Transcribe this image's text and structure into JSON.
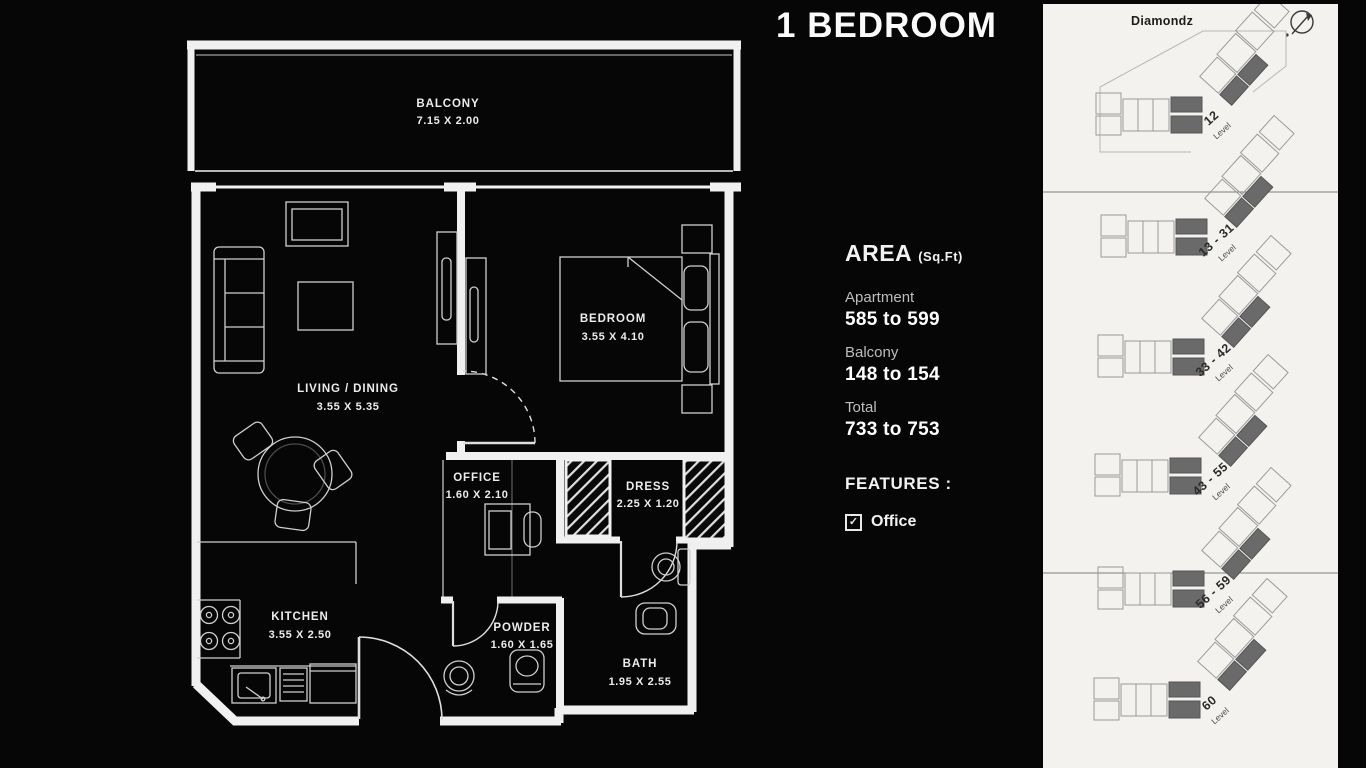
{
  "title": "1 BEDROOM",
  "area": {
    "heading": "AREA",
    "unit": "(Sq.Ft)",
    "rows": [
      {
        "label": "Apartment",
        "value": "585 to 599"
      },
      {
        "label": "Balcony",
        "value": "148 to 154"
      },
      {
        "label": "Total",
        "value": "733 to 753"
      }
    ]
  },
  "features": {
    "heading": "FEATURES :",
    "check_glyph": "✓",
    "items": [
      {
        "label": "Office"
      }
    ]
  },
  "floorplan": {
    "rooms": [
      {
        "name": "BALCONY",
        "dims": "7.15 X 2.00"
      },
      {
        "name": "LIVING / DINING",
        "dims": "3.55 X 5.35"
      },
      {
        "name": "BEDROOM",
        "dims": "3.55 X 4.10"
      },
      {
        "name": "OFFICE",
        "dims": "1.60 X 2.10"
      },
      {
        "name": "DRESS",
        "dims": "2.25 X 1.20"
      },
      {
        "name": "KITCHEN",
        "dims": "3.55 X 2.50"
      },
      {
        "name": "POWDER",
        "dims": "1.60 X 1.65"
      },
      {
        "name": "BATH",
        "dims": "1.95 X 2.55"
      }
    ]
  },
  "keyplan": {
    "project": "Diamondz",
    "levels": [
      {
        "range": "12",
        "word": "Level"
      },
      {
        "range": "13 - 31",
        "word": "Level"
      },
      {
        "range": "33 - 42",
        "word": "Level"
      },
      {
        "range": "43 - 55",
        "word": "Level"
      },
      {
        "range": "56 - 59",
        "word": "Level"
      },
      {
        "range": "60",
        "word": "Level"
      }
    ]
  },
  "colors": {
    "background": "#060606",
    "wall_line": "#f0f0f0",
    "furniture_line": "#cfcfcf",
    "panel": "#f3f2ef",
    "highlight_unit": "#6a6a6a"
  }
}
